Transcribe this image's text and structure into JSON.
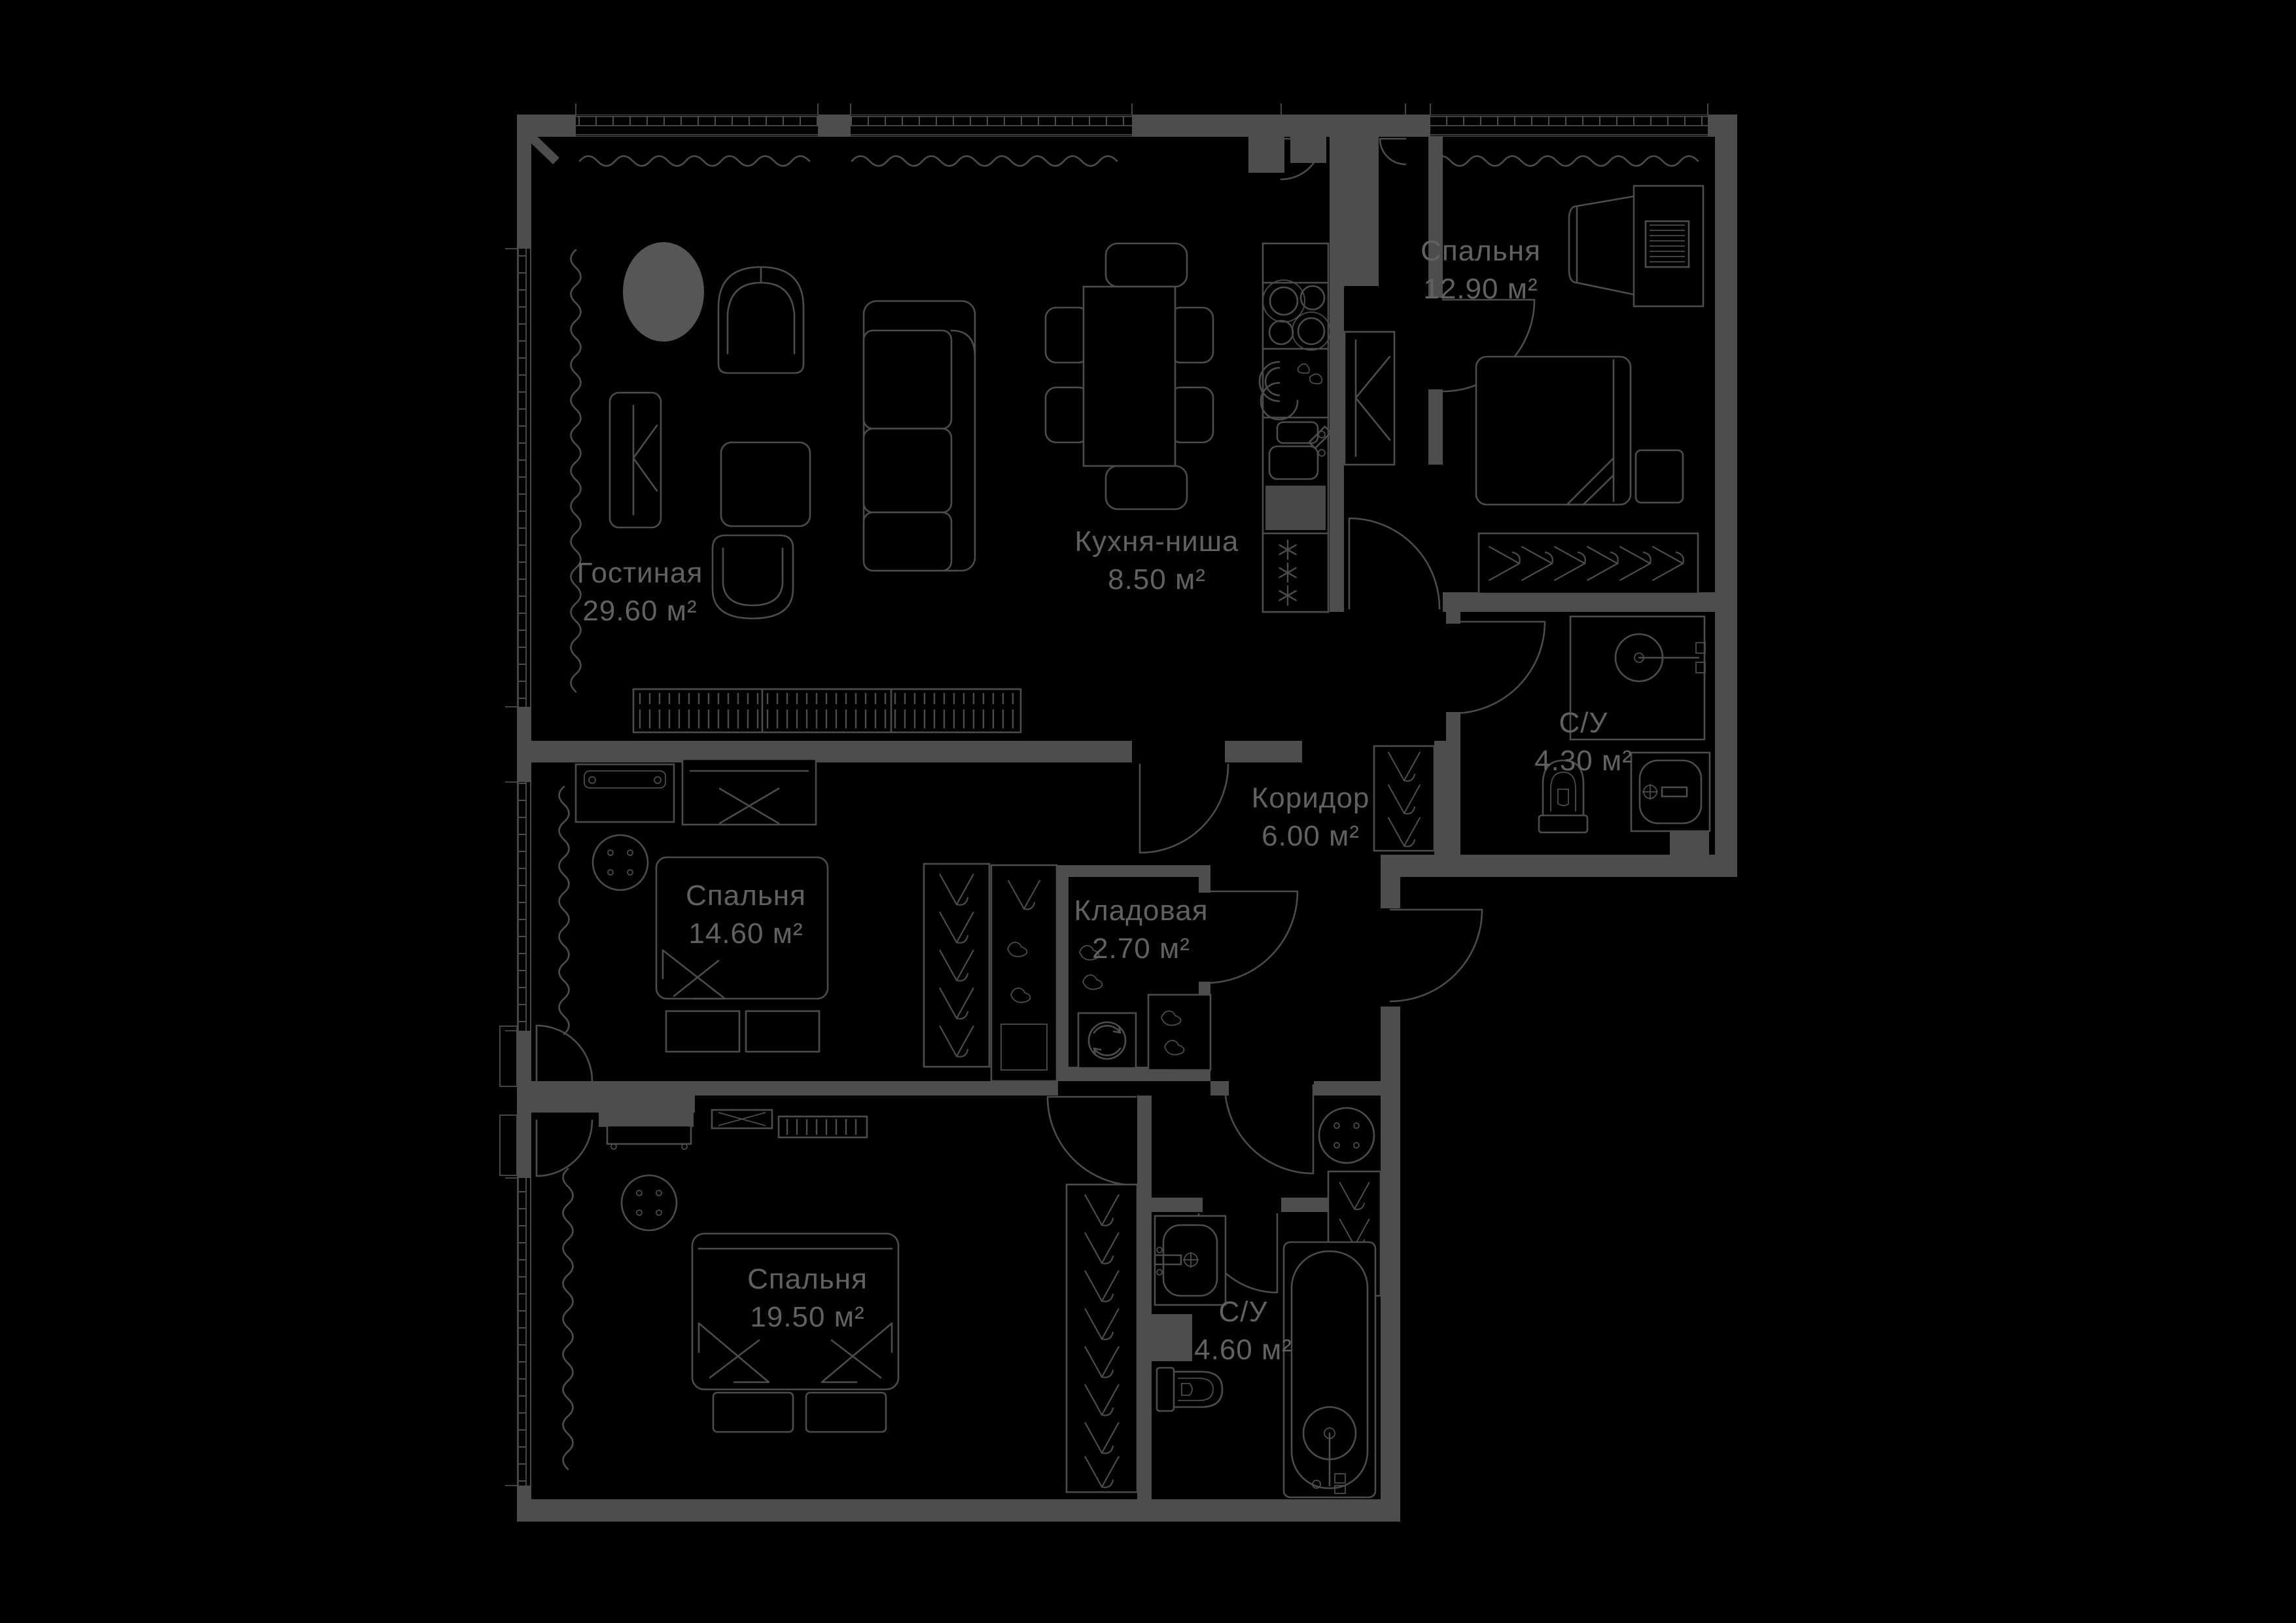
{
  "floorplan": {
    "background_color": "#000000",
    "wall_color": "#4d4d4d",
    "furniture_line_color": "#4c4c4c",
    "label_color": "#616161",
    "area_unit": "м²",
    "rooms": [
      {
        "key": "living",
        "name": "Гостиная",
        "area": "29.60",
        "area_label": "29.60 м²"
      },
      {
        "key": "kitchen",
        "name": "Кухня-ниша",
        "area": "8.50",
        "area_label": "8.50 м²"
      },
      {
        "key": "bedroom-1",
        "name": "Спальня",
        "area": "12.90",
        "area_label": "12.90 м²"
      },
      {
        "key": "bathroom-1",
        "name": "С/У",
        "area": "4.30",
        "area_label": "4.30 м²"
      },
      {
        "key": "corridor",
        "name": "Коридор",
        "area": "6.00",
        "area_label": "6.00 м²"
      },
      {
        "key": "bedroom-2",
        "name": "Спальня",
        "area": "14.60",
        "area_label": "14.60 м²"
      },
      {
        "key": "storage",
        "name": "Кладовая",
        "area": "2.70",
        "area_label": "2.70 м²"
      },
      {
        "key": "bedroom-3",
        "name": "Спальня",
        "area": "19.50",
        "area_label": "19.50 м²"
      },
      {
        "key": "bathroom-2",
        "name": "С/У",
        "area": "4.60",
        "area_label": "4.60 м²"
      }
    ]
  }
}
